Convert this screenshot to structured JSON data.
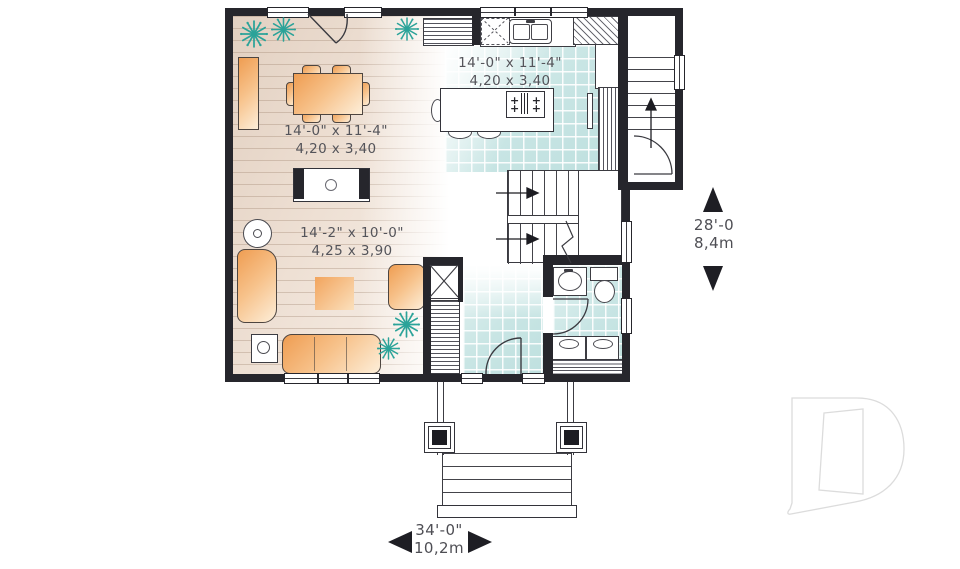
{
  "labels": {
    "dining": {
      "imperial": "14'-0\" x 11'-4\"",
      "metric": "4,20 x 3,40"
    },
    "kitchen": {
      "imperial": "14'-0\" x 11'-4\"",
      "metric": "4,20 x 3,40"
    },
    "living": {
      "imperial": "14'-2\" x 10'-0\"",
      "metric": "4,25 x 3,90"
    }
  },
  "dimensions": {
    "depth_imperial": "28'-0",
    "depth_metric": "8,4m",
    "width_imperial": "34'-0\"",
    "width_metric": "10,2m"
  },
  "cooktop_plus": "+",
  "colors": {
    "wall": "#26262c",
    "tile": "#c8e5e4",
    "wood": "#e2d0c1",
    "furniture_orange": "#ef9d52",
    "plant_teal": "#2ba399",
    "label_gray": "#54545a",
    "logo_gray": "#dcdcdc"
  }
}
